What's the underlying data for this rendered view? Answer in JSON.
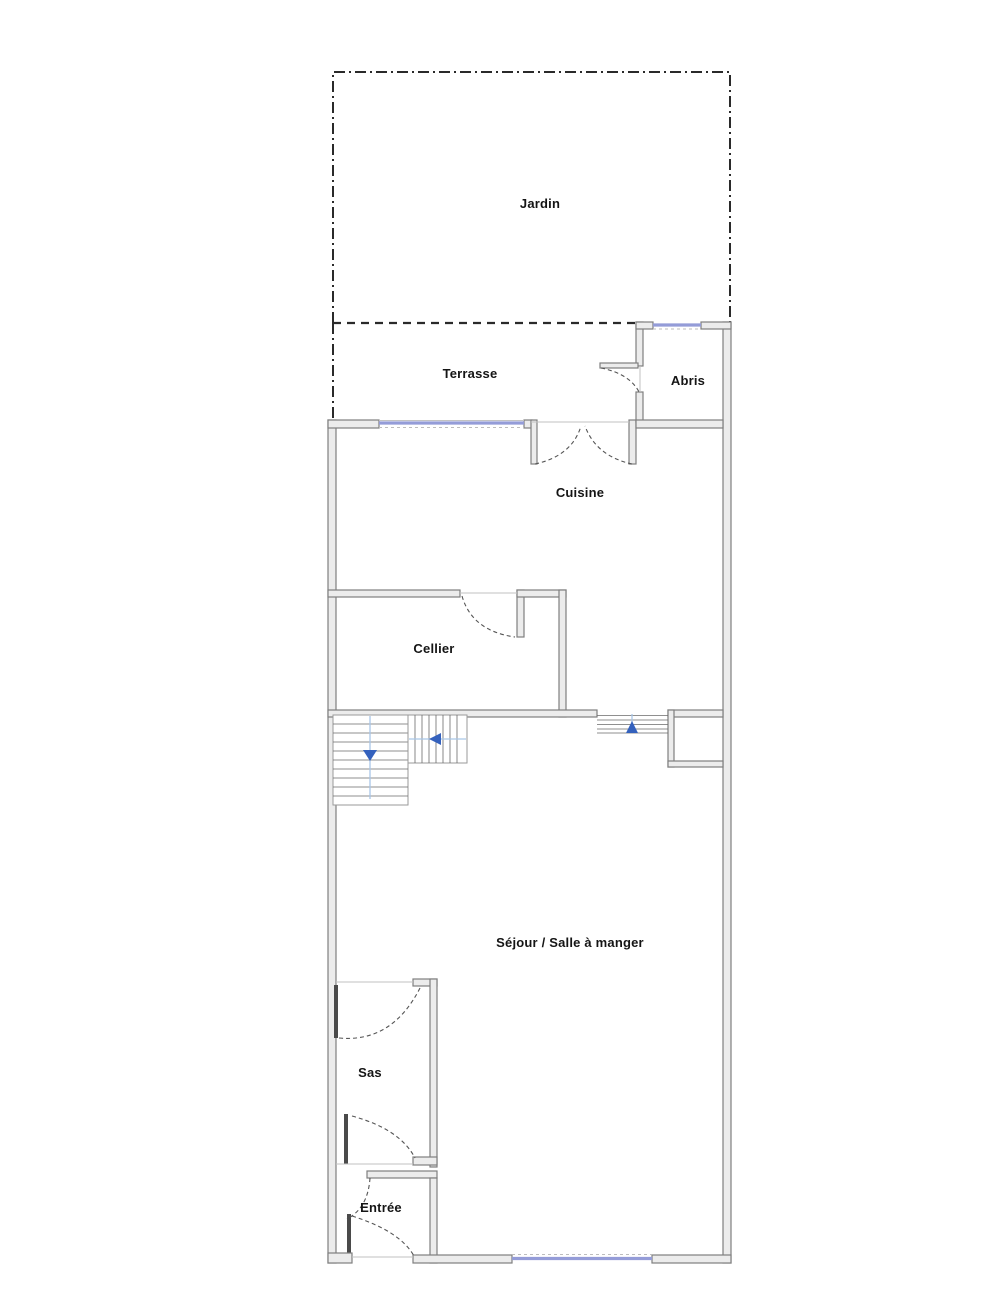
{
  "rooms": {
    "jardin": {
      "label": "Jardin"
    },
    "terrasse": {
      "label": "Terrasse"
    },
    "abris": {
      "label": "Abris"
    },
    "cuisine": {
      "label": "Cuisine"
    },
    "cellier": {
      "label": "Cellier"
    },
    "sejour": {
      "label": "Séjour / Salle à manger"
    },
    "sas": {
      "label": "Sas"
    },
    "entree": {
      "label": "Entrée"
    }
  },
  "colors": {
    "window": "#949cd8",
    "stair_arrow": "#3461bd",
    "stair_guide": "#a9c6e8",
    "wall_fill": "#ececec",
    "wall_stroke": "#7f7f7f",
    "boundary": "#2a2a2a",
    "label": "#151515"
  },
  "icons": {
    "stairs_down_arrow": "▼",
    "stairs_left_arrow": "◀",
    "steps_up_arrow": "▲"
  }
}
